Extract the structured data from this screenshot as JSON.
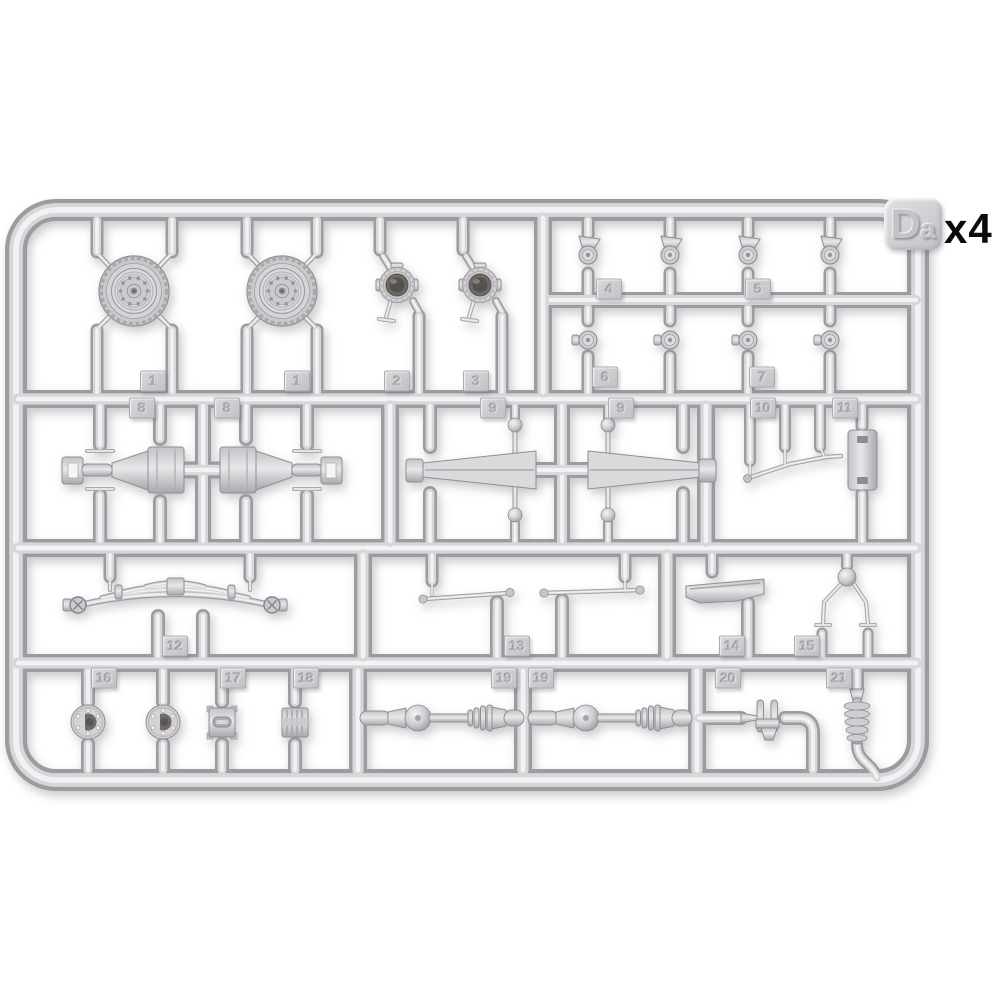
{
  "sprue": {
    "corner_label": "Da",
    "quantity_label": "x4",
    "plastic_color": "#d2d2d5",
    "background_color": "#ffffff",
    "part_tags": [
      {
        "label": "1",
        "x": 153,
        "y": 381
      },
      {
        "label": "1",
        "x": 297,
        "y": 381
      },
      {
        "label": "2",
        "x": 397,
        "y": 381
      },
      {
        "label": "3",
        "x": 476,
        "y": 381
      },
      {
        "label": "4",
        "x": 609,
        "y": 289
      },
      {
        "label": "5",
        "x": 758,
        "y": 289
      },
      {
        "label": "6",
        "x": 605,
        "y": 377
      },
      {
        "label": "7",
        "x": 762,
        "y": 377
      },
      {
        "label": "8",
        "x": 142,
        "y": 408
      },
      {
        "label": "8",
        "x": 227,
        "y": 408
      },
      {
        "label": "9",
        "x": 493,
        "y": 408
      },
      {
        "label": "9",
        "x": 621,
        "y": 408
      },
      {
        "label": "10",
        "x": 763,
        "y": 408
      },
      {
        "label": "11",
        "x": 845,
        "y": 408
      },
      {
        "label": "12",
        "x": 175,
        "y": 646
      },
      {
        "label": "13",
        "x": 517,
        "y": 646
      },
      {
        "label": "14",
        "x": 732,
        "y": 646
      },
      {
        "label": "15",
        "x": 807,
        "y": 646
      },
      {
        "label": "16",
        "x": 104,
        "y": 678
      },
      {
        "label": "17",
        "x": 233,
        "y": 678
      },
      {
        "label": "18",
        "x": 306,
        "y": 678
      },
      {
        "label": "19",
        "x": 504,
        "y": 678
      },
      {
        "label": "19",
        "x": 541,
        "y": 678
      },
      {
        "label": "20",
        "x": 728,
        "y": 678
      },
      {
        "label": "21",
        "x": 839,
        "y": 678
      }
    ]
  }
}
